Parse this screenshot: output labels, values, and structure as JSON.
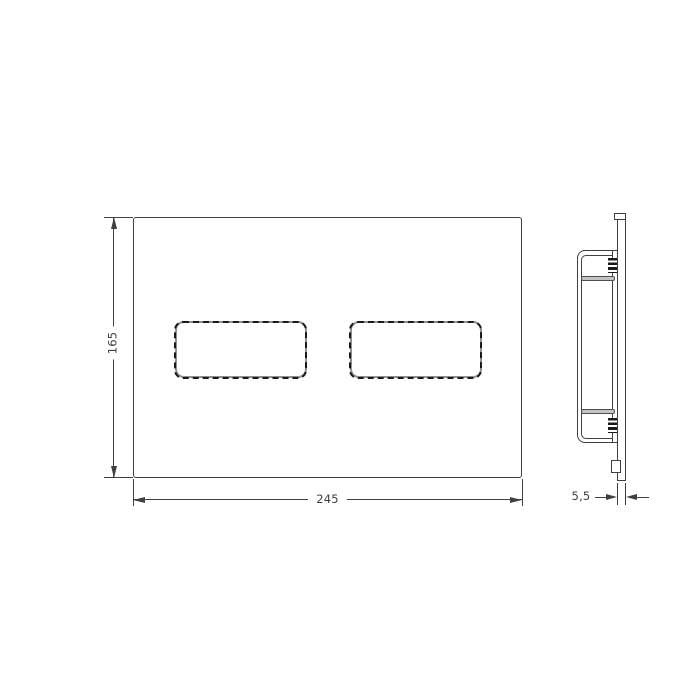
{
  "drawing": {
    "dimensions": {
      "height": "165",
      "width": "245",
      "thickness": "5,5"
    },
    "colors": {
      "line": "#404040",
      "button_outline": "#909090",
      "dash": "#1a1a1a",
      "bar_fill": "#c4c4c4",
      "bar_edge": "#4f4f4f",
      "background": "#ffffff"
    }
  }
}
